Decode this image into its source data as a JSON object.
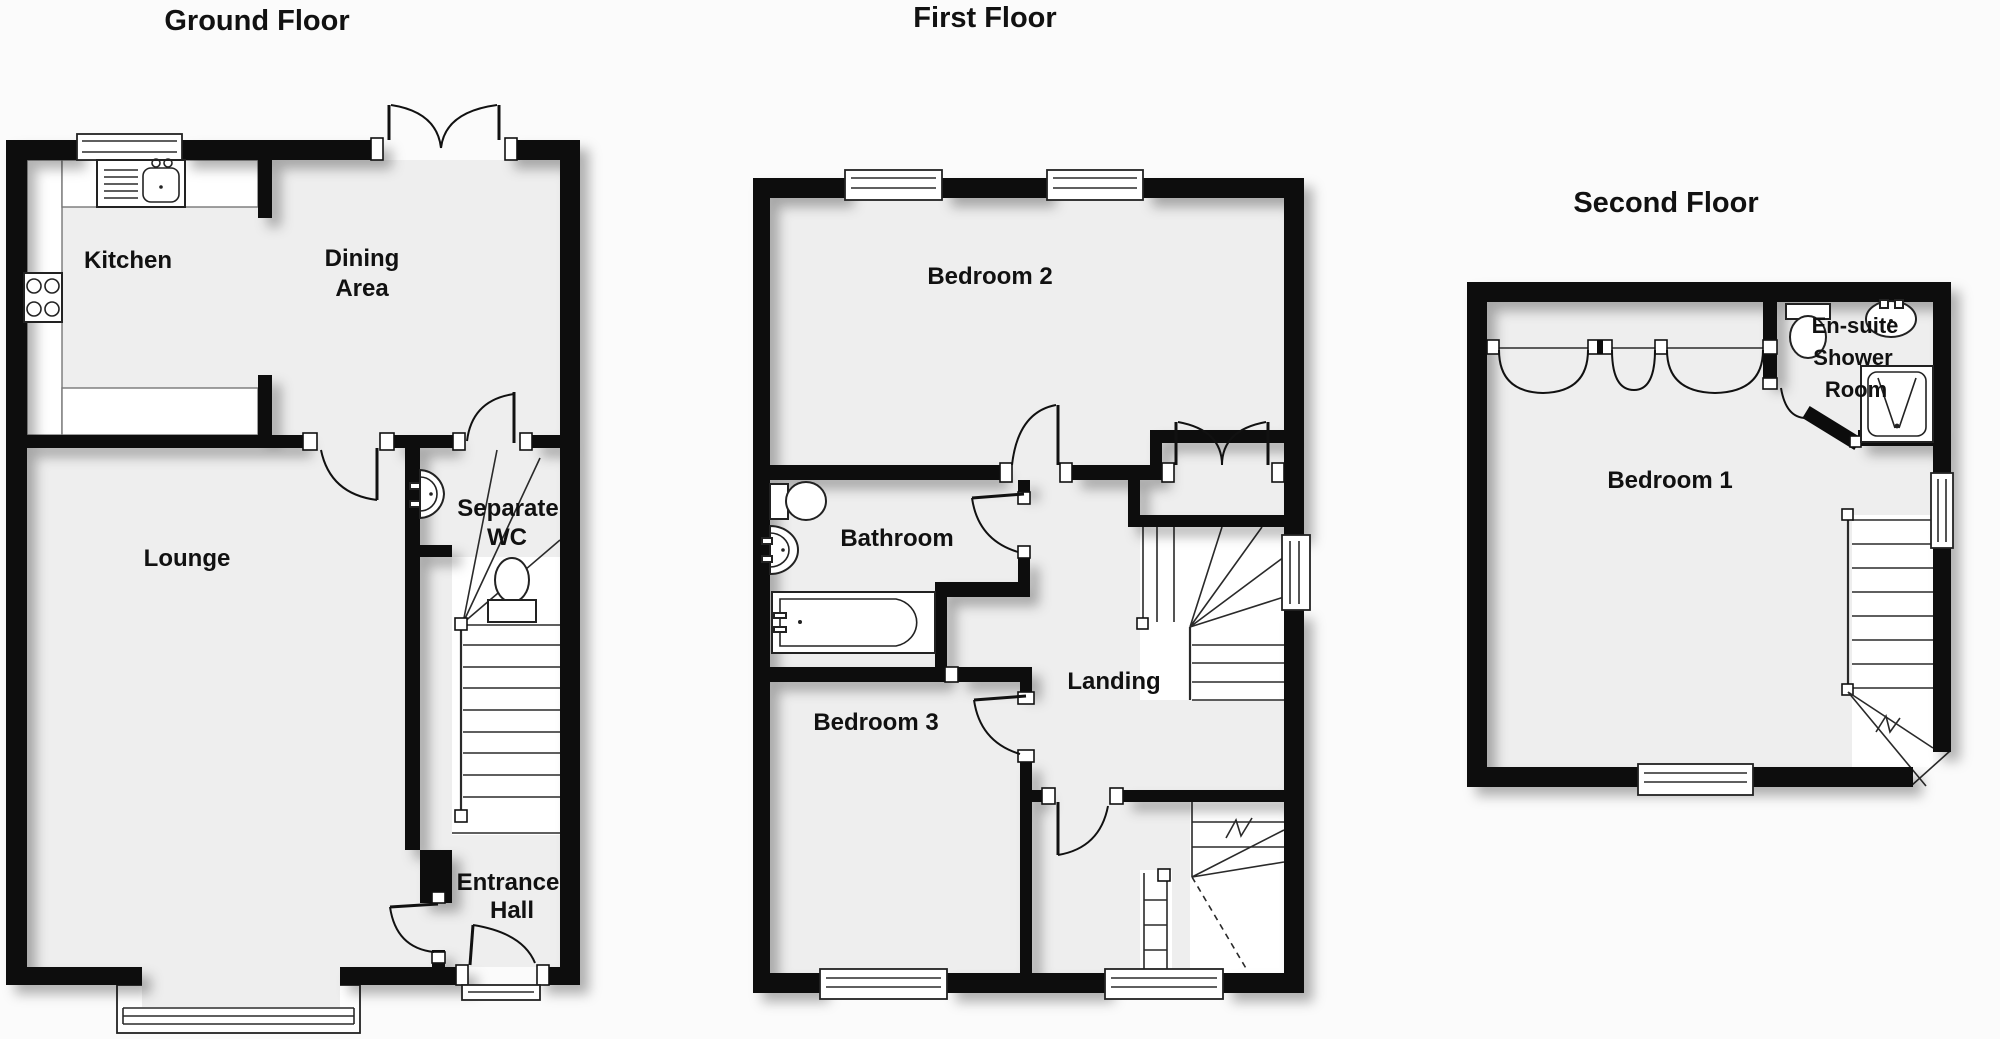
{
  "colors": {
    "wall": "#0c0c0c",
    "floor": "#eeeeee",
    "background": "#fbfbfb",
    "line": "#1a1a1a"
  },
  "floors": {
    "ground": {
      "title": "Ground Floor",
      "rooms": {
        "kitchen": "Kitchen",
        "dining_line1": "Dining",
        "dining_line2": "Area",
        "lounge": "Lounge",
        "wc_line1": "Separate",
        "wc_line2": "WC",
        "hall_line1": "Entrance",
        "hall_line2": "Hall"
      }
    },
    "first": {
      "title": "First Floor",
      "rooms": {
        "bedroom2": "Bedroom 2",
        "bathroom": "Bathroom",
        "landing": "Landing",
        "bedroom3": "Bedroom 3"
      }
    },
    "second": {
      "title": "Second Floor",
      "rooms": {
        "bedroom1": "Bedroom 1",
        "ensuite_line1": "En-suite",
        "ensuite_line2": "Shower",
        "ensuite_line3": "Room"
      }
    }
  }
}
